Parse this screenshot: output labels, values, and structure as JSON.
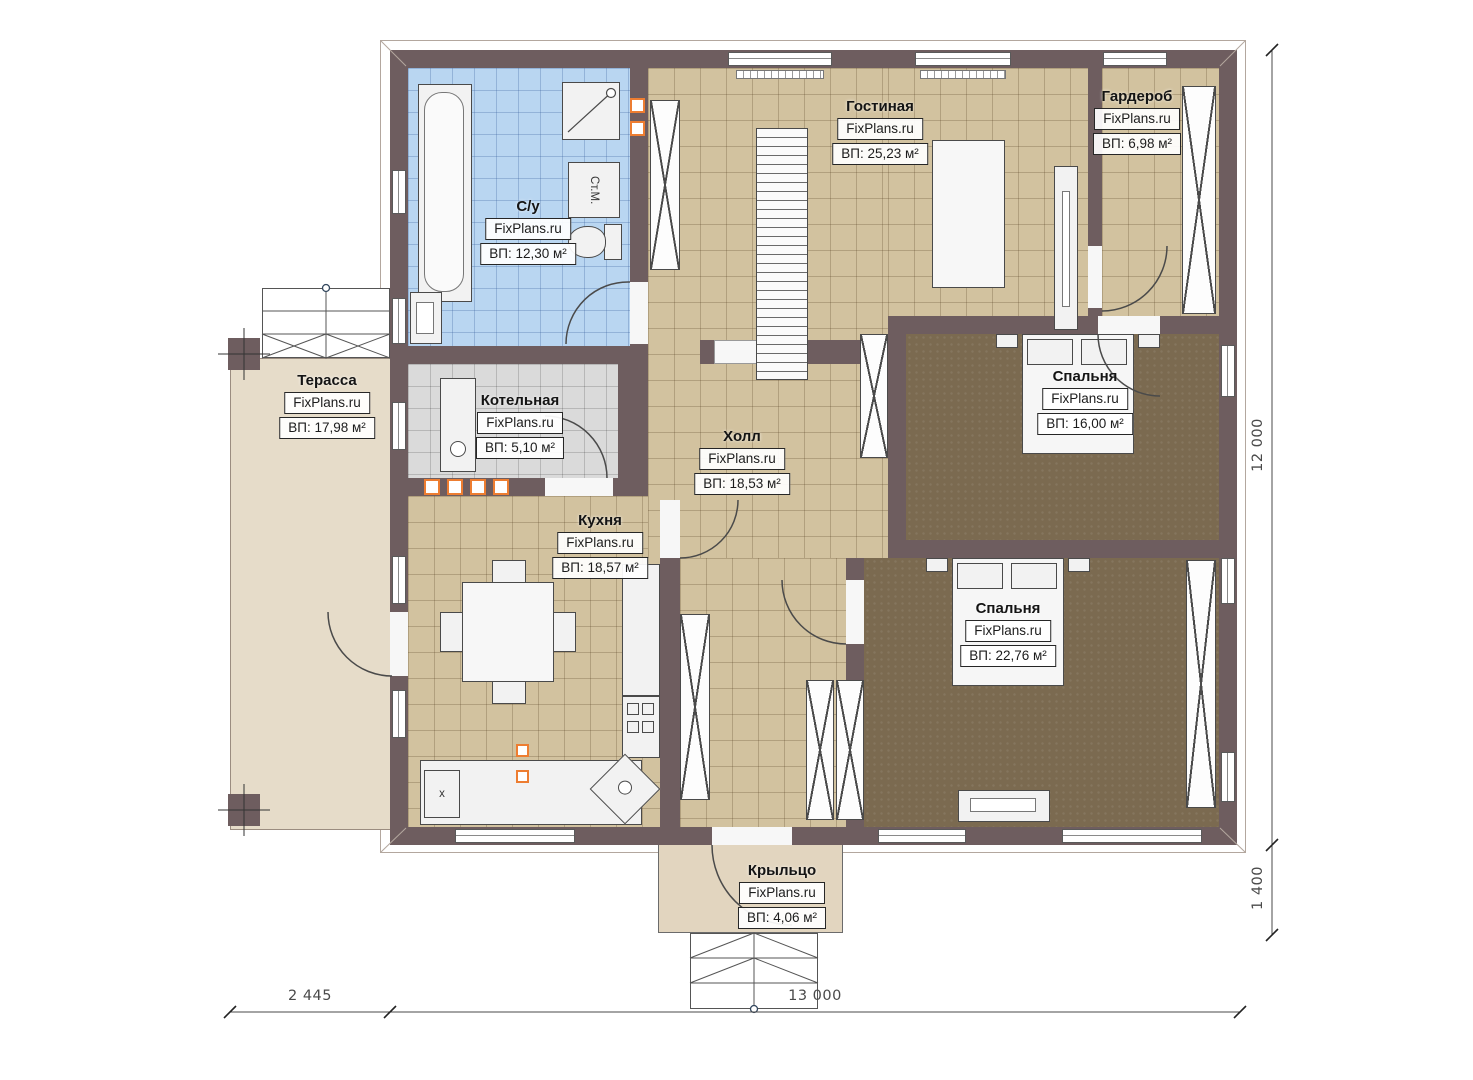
{
  "watermark": "FixPlans.ru",
  "rooms": [
    {
      "id": "living",
      "name": "Гостиная",
      "area": "ВП: 25,23 м²"
    },
    {
      "id": "wardrobe",
      "name": "Гардероб",
      "area": "ВП: 6,98 м²"
    },
    {
      "id": "bathroom",
      "name": "С/у",
      "area": "ВП: 12,30 м²"
    },
    {
      "id": "terrace",
      "name": "Терасса",
      "area": "ВП: 17,98 м²"
    },
    {
      "id": "boiler",
      "name": "Котельная",
      "area": "ВП: 5,10 м²"
    },
    {
      "id": "hall",
      "name": "Холл",
      "area": "ВП: 18,53 м²"
    },
    {
      "id": "kitchen",
      "name": "Кухня",
      "area": "ВП: 18,57 м²"
    },
    {
      "id": "bedroom-1",
      "name": "Спальня",
      "area": "ВП: 16,00 м²"
    },
    {
      "id": "bedroom-2",
      "name": "Спальня",
      "area": "ВП: 22,76 м²"
    },
    {
      "id": "porch",
      "name": "Крыльцо",
      "area": "ВП: 4,06 м²"
    }
  ],
  "dimensions": {
    "terrace_width": "2 445",
    "house_width": "13 000",
    "house_depth": "12 000",
    "porch_depth": "1 400"
  },
  "equipment_labels": {
    "washing_machine": "Ст.М.",
    "kitchen_unit": "x"
  },
  "colors": {
    "wall": "#6e5d5f",
    "bathroom_floor": "#b9d6f1",
    "tile_floor": "#d2c29f",
    "bedroom_floor": "#7b6a50",
    "boiler_floor": "#dadada",
    "terrace_floor": "#e6dcc9",
    "porch_floor": "#e2d5bf",
    "accent": "#ed7d31",
    "line": "#4a4a4a"
  }
}
